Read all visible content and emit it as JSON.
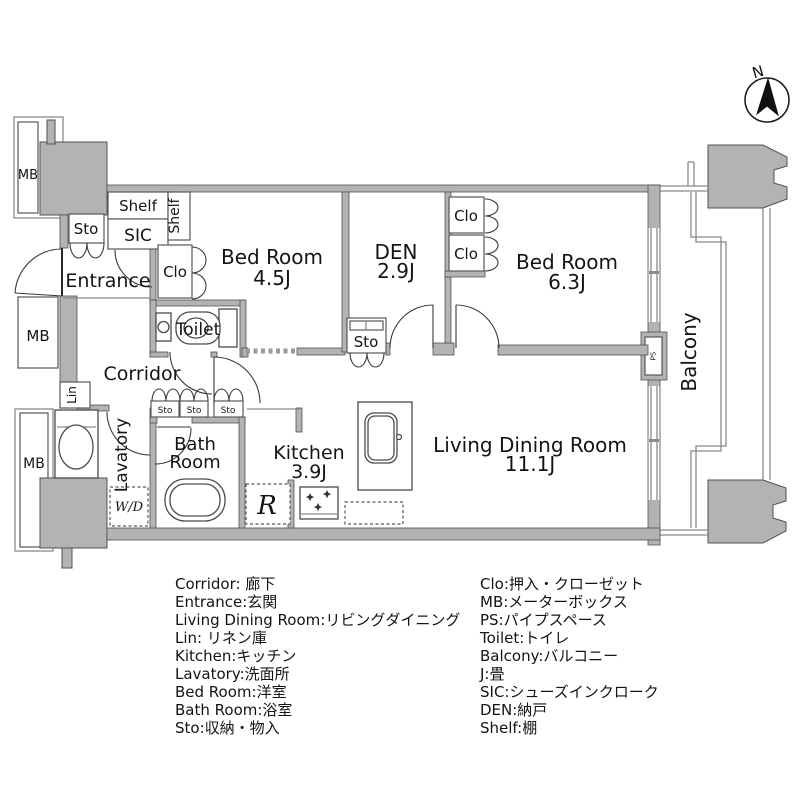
{
  "compass": {
    "north_label": "N"
  },
  "plan": {
    "mb_label": "MB",
    "sto_label": "Sto",
    "clo_label": "Clo",
    "shelf_label": "Shelf",
    "sic_label": "SIC",
    "entrance_label": "Entrance",
    "corridor_label": "Corridor",
    "toilet_label": "Toilet",
    "lin_label": "Lin",
    "lavatory_label": "Lavatory",
    "wd_label": "W/D",
    "bath_line1": "Bath",
    "bath_line2": "Room",
    "kitchen_line1": "Kitchen",
    "kitchen_line2": "3.9J",
    "refrigerator_label": "R",
    "bedroom1_line1": "Bed Room",
    "bedroom1_line2": "4.5J",
    "den_line1": "DEN",
    "den_line2": "2.9J",
    "bedroom2_line1": "Bed Room",
    "bedroom2_line2": "6.3J",
    "ldk_line1": "Living Dining Room",
    "ldk_line2": "11.1J",
    "balcony_label": "Balcony",
    "ps_label": "PS"
  },
  "legend": {
    "left": [
      "Corridor: 廊下",
      "Entrance:玄関",
      "Living Dining Room:リビングダイニング",
      "Lin: リネン庫",
      "Kitchen:キッチン",
      "Lavatory:洗面所",
      "Bed Room:洋室",
      "Bath Room:浴室",
      "Sto:収納・物入"
    ],
    "right": [
      "Clo:押入・クローゼット",
      "MB:メーターボックス",
      "PS:パイプスペース",
      "Toilet:トイレ",
      "Balcony:バルコニー",
      "J:畳",
      "SIC:シューズインクローク",
      "DEN:納戸",
      "Shelf:棚"
    ]
  }
}
